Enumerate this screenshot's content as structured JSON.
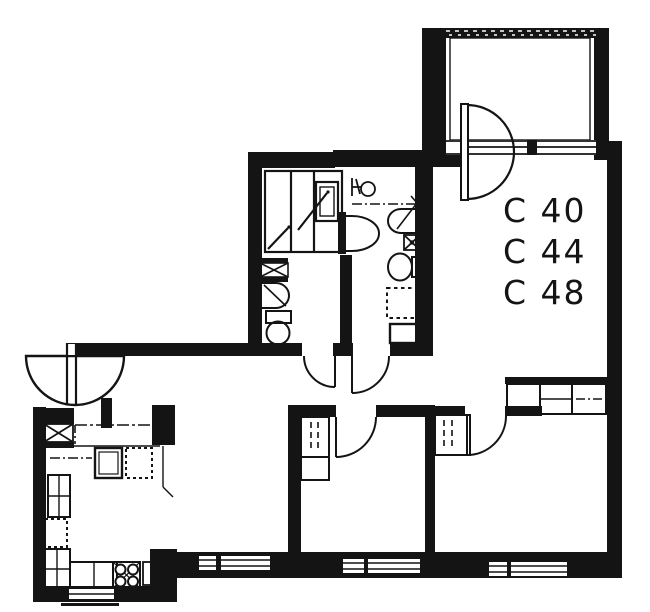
{
  "page": {
    "background": "#ffffff",
    "ink": "#141414"
  },
  "plan": {
    "type": "apartment-floor-plan",
    "unit_labels": [
      "C 40",
      "C 44",
      "C 48"
    ]
  }
}
